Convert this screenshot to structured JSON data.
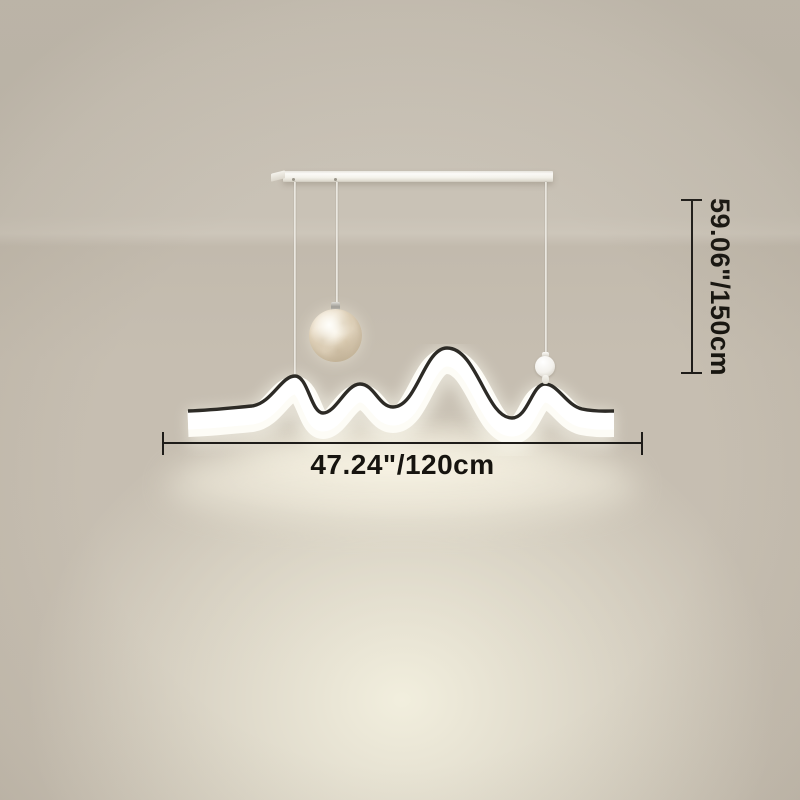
{
  "scene": {
    "background_color": "#c7c0b3",
    "glow_color": "#f2efdf"
  },
  "fixture": {
    "canopy_color": "#f7f5ef",
    "frame_line_color": "#2d2b26",
    "led_light_color": "#fdfcf6",
    "moon_shade_color": "#ecdfc9",
    "accent_ball_color": "#f3f1ec"
  },
  "annotations": {
    "width_label": "47.24\"/120cm",
    "height_label": "59.06\"/150cm",
    "line_color": "#1e1c19"
  }
}
